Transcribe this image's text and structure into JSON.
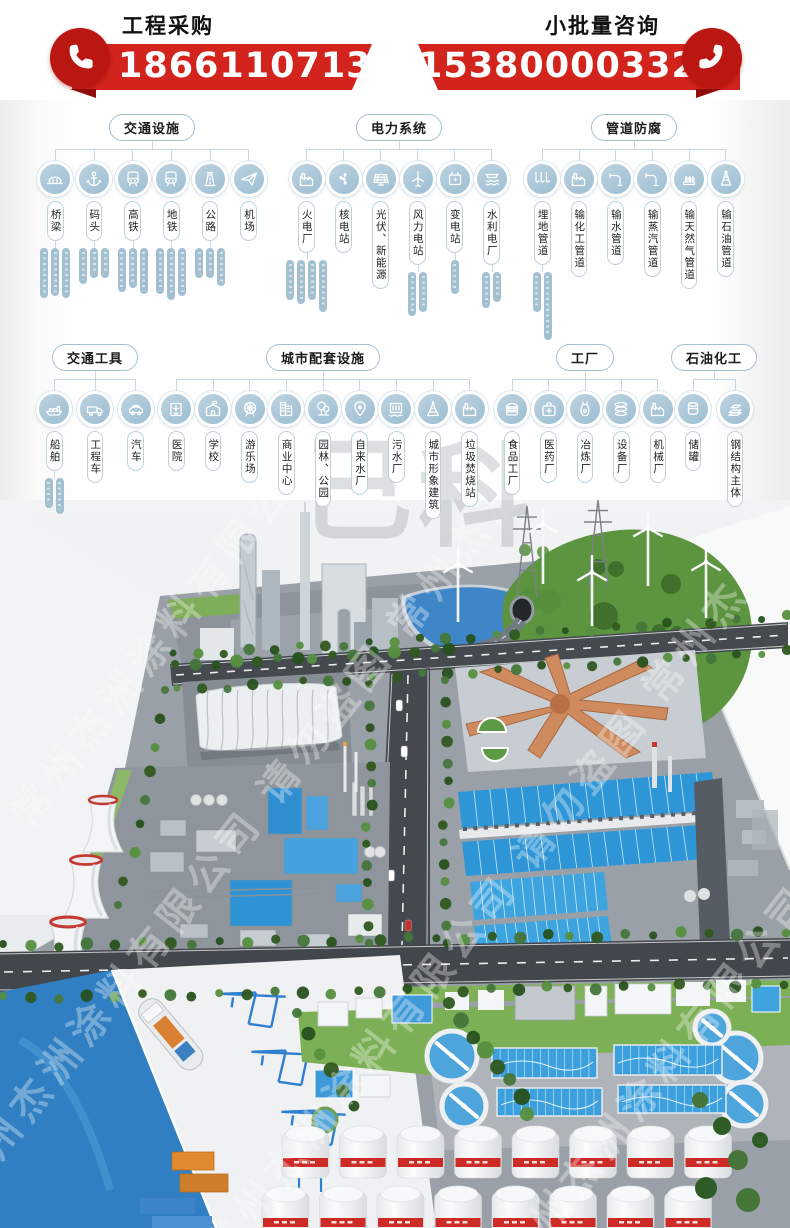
{
  "topbar": {
    "left": {
      "title": "工程采购",
      "phone": "18661107130"
    },
    "right": {
      "title": "小批量咨询",
      "phone": "15380000332"
    }
  },
  "colors": {
    "brand_red": "#d2231d",
    "node_blue": "#a9c6d6",
    "line": "#c9d8e0"
  },
  "diagram": {
    "rows": [
      {
        "sections": [
          {
            "title": "交通设施",
            "items": [
              {
                "label": "桥梁",
                "icon": "bridge",
                "capsules": [
                  50,
                  48,
                  50
                ]
              },
              {
                "label": "码头",
                "icon": "anchor",
                "capsules": [
                  36,
                  30,
                  30
                ]
              },
              {
                "label": "高铁",
                "icon": "train",
                "capsules": [
                  44,
                  40,
                  46
                ]
              },
              {
                "label": "地铁",
                "icon": "train",
                "capsules": [
                  46,
                  52,
                  48
                ]
              },
              {
                "label": "公路",
                "icon": "road",
                "capsules": [
                  30,
                  30,
                  38
                ]
              },
              {
                "label": "机场",
                "icon": "plane",
                "capsules": []
              }
            ]
          },
          {
            "title": "电力系统",
            "items": [
              {
                "label": "火电厂",
                "icon": "factory",
                "capsules": [
                  40,
                  44,
                  40,
                  52
                ]
              },
              {
                "label": "核电站",
                "icon": "fan",
                "capsules": []
              },
              {
                "label": "光伏、新能源",
                "icon": "solar",
                "capsules": []
              },
              {
                "label": "风力电站",
                "icon": "wind",
                "capsules": [
                  44,
                  40
                ]
              },
              {
                "label": "变电站",
                "icon": "battery",
                "capsules": [
                  34
                ]
              },
              {
                "label": "水利电厂",
                "icon": "hydro",
                "capsules": [
                  36,
                  30
                ]
              }
            ]
          },
          {
            "title": "管道防腐",
            "items": [
              {
                "label": "埋地管道",
                "icon": "pipes3",
                "capsules": [
                  40,
                  68
                ]
              },
              {
                "label": "输化工管道",
                "icon": "factory",
                "capsules": []
              },
              {
                "label": "输水管道",
                "icon": "pipe",
                "capsules": []
              },
              {
                "label": "输蒸汽管道",
                "icon": "pipe",
                "capsules": []
              },
              {
                "label": "输天然气管道",
                "icon": "flame",
                "capsules": []
              },
              {
                "label": "输石油管道",
                "icon": "derrick",
                "capsules": []
              }
            ]
          }
        ]
      },
      {
        "sections": [
          {
            "title": "交通工具",
            "items": [
              {
                "label": "船舶",
                "icon": "ship",
                "capsules": [
                  30,
                  36
                ]
              },
              {
                "label": "工程车",
                "icon": "truck",
                "capsules": []
              },
              {
                "label": "汽车",
                "icon": "car",
                "capsules": []
              }
            ]
          },
          {
            "title": "城市配套设施",
            "items": [
              {
                "label": "医院",
                "icon": "hospital",
                "capsules": []
              },
              {
                "label": "学校",
                "icon": "school",
                "capsules": []
              },
              {
                "label": "游乐场",
                "icon": "ferris",
                "capsules": []
              },
              {
                "label": "商业中心",
                "icon": "mall",
                "capsules": []
              },
              {
                "label": "园林、公园",
                "icon": "tree",
                "capsules": []
              },
              {
                "label": "自来水厂",
                "icon": "pin",
                "capsules": []
              },
              {
                "label": "污水厂",
                "icon": "sewage",
                "capsules": []
              },
              {
                "label": "城市形象建筑",
                "icon": "tower",
                "capsules": []
              },
              {
                "label": "垃圾焚烧站",
                "icon": "factory",
                "capsules": []
              }
            ]
          },
          {
            "title": "工厂",
            "items": [
              {
                "label": "食品工厂",
                "icon": "burger",
                "capsules": []
              },
              {
                "label": "医药厂",
                "icon": "medbag",
                "capsules": []
              },
              {
                "label": "冶炼厂",
                "icon": "furnace",
                "capsules": []
              },
              {
                "label": "设备厂",
                "icon": "disks",
                "capsules": []
              },
              {
                "label": "机械厂",
                "icon": "factory",
                "capsules": []
              }
            ]
          },
          {
            "title": "石油化工",
            "items": [
              {
                "label": "储罐",
                "icon": "tank",
                "capsules": []
              },
              {
                "label": "钢结构主体",
                "icon": "steel",
                "capsules": []
              }
            ]
          }
        ]
      }
    ]
  },
  "photo": {
    "watermark": "常州杰洲涂料有限公司 请勿盗图",
    "watermark_repeat": "常州杰洲涂料有限公司 请勿盗图 常州杰洲涂料有限公司 请勿盗图",
    "brand_chars": [
      "己",
      "科"
    ]
  }
}
